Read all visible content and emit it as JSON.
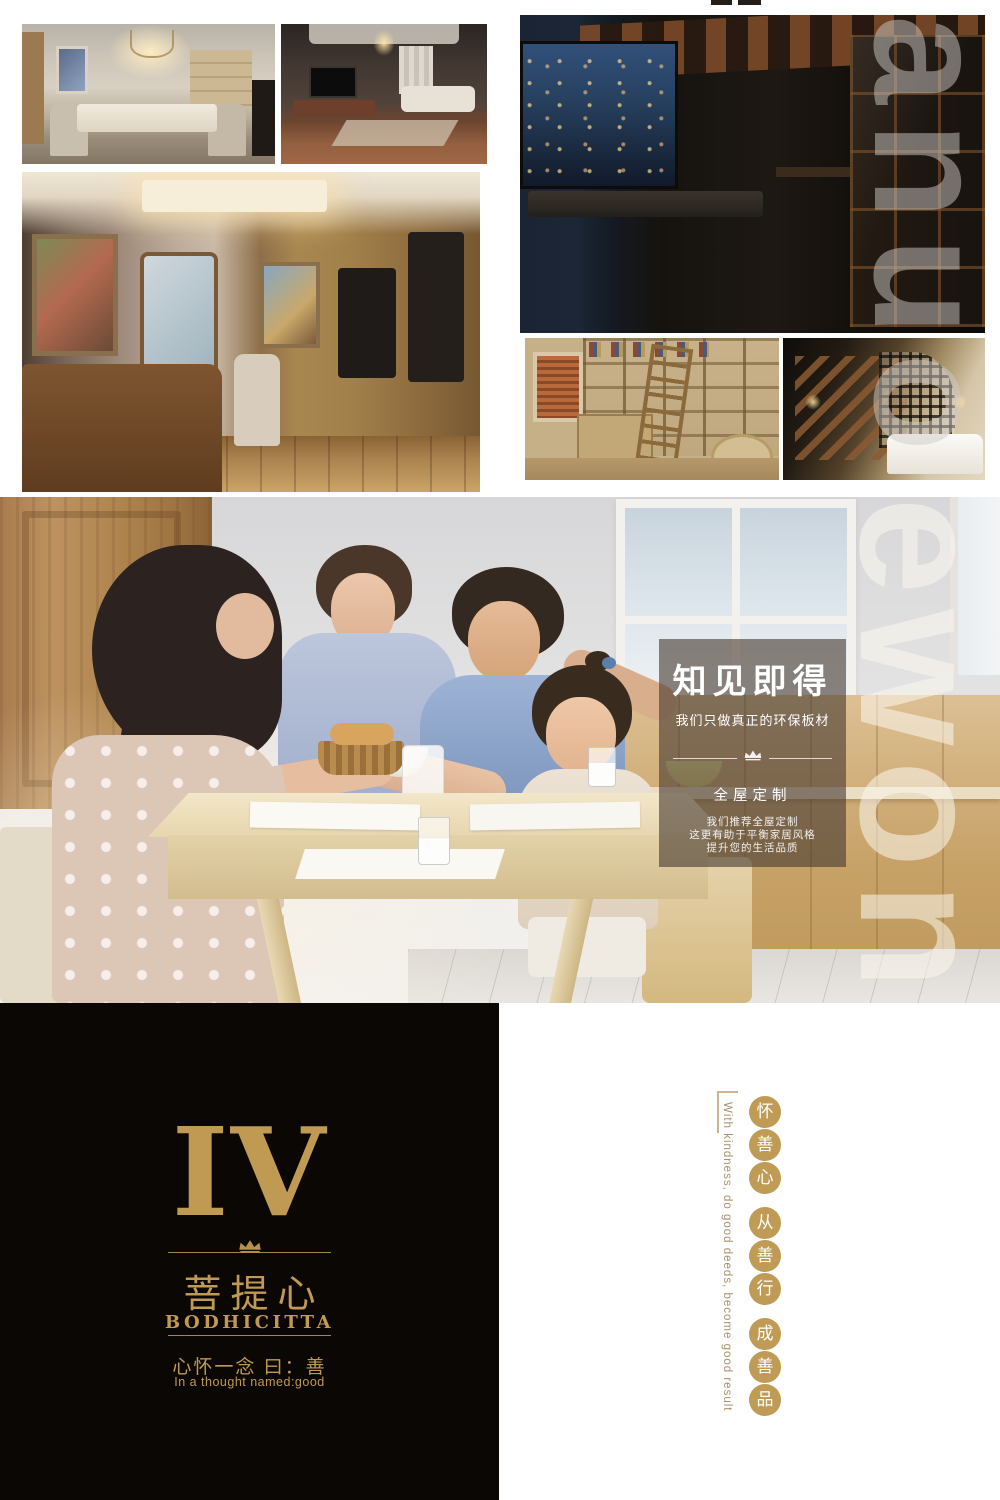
{
  "colors": {
    "gold": "#c09a52",
    "circle_gold": "#bf9b55",
    "black_block": "#0a0705",
    "panel_overlay": "rgba(72,60,50,0.62)"
  },
  "gallery": {
    "photos": [
      {
        "id": "dining-room",
        "desc": "European style dining room with chandelier"
      },
      {
        "id": "living-room",
        "desc": "Dark new-Chinese living room with TV wall"
      },
      {
        "id": "walk-in-wardrobe",
        "desc": "Walk-in wardrobe with classic dresser and mirror"
      },
      {
        "id": "night-hallway",
        "desc": "Hallway with night city window and wood slat ceiling"
      },
      {
        "id": "study-bookshelves",
        "desc": "Study with wooden bookshelves and ladder"
      },
      {
        "id": "loft-bedroom",
        "desc": "Loft bedroom with staircase and lattice screen"
      }
    ]
  },
  "family_section": {
    "desc": "Family having breakfast at a wooden table"
  },
  "overlay_panel": {
    "title": "知见即得",
    "subtitle": "我们只做真正的环保板材",
    "section_title": "全屋定制",
    "lines": [
      "我们推荐全屋定制",
      "这更有助于平衡家居风格",
      "提升您的生活品质"
    ]
  },
  "chapter": {
    "numeral": "IV",
    "title_cn": "菩提心",
    "title_en": "BODHICITTA",
    "motto_cn": "心怀一念 曰：善",
    "motto_en": "In a thought  named:good"
  },
  "side_slogan": {
    "groups": [
      [
        "怀",
        "善",
        "心"
      ],
      [
        "从",
        "善",
        "行"
      ],
      [
        "成",
        "善",
        "品"
      ]
    ],
    "english": "With kindness, do good deeds, become good result"
  },
  "watermark": {
    "segments": [
      {
        "text": "anuo"
      },
      {
        "text": "ewon"
      },
      {
        "text": "uads"
      }
    ]
  },
  "icons": {
    "crown": "crown"
  }
}
